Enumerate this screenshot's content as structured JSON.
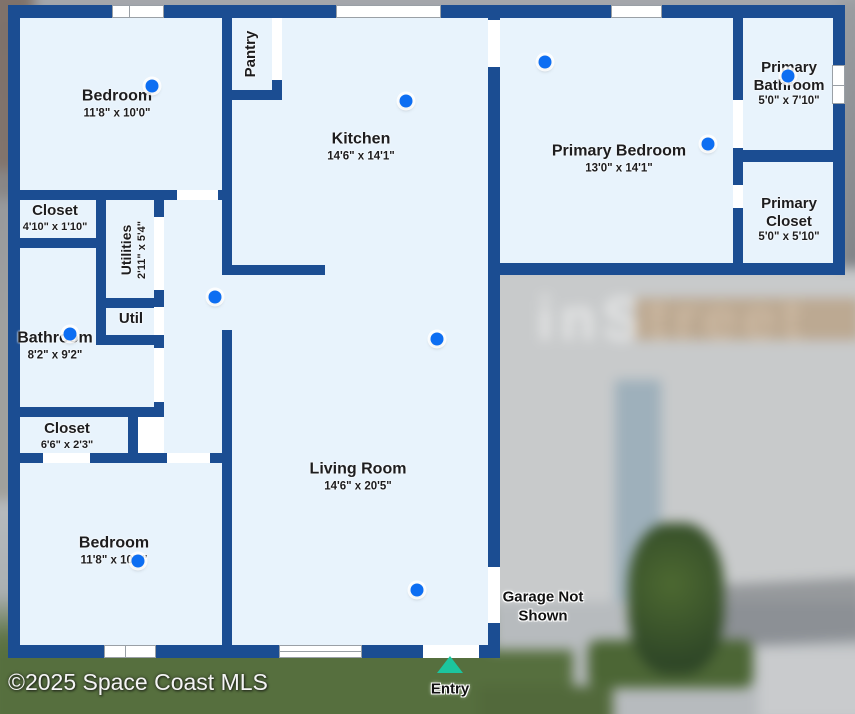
{
  "meta": {
    "copyright": "©2025 Space Coast MLS",
    "watermark": "inStreet"
  },
  "colors": {
    "wall": "#1b4d92",
    "room": "#e8f3fc",
    "dot": "#0d6ef2",
    "entry": "#1cc59e",
    "ink": "#1d1d1f"
  },
  "rooms": {
    "bedroom_top": {
      "name": "Bedroom",
      "dims": "11'8\" x 10'0\""
    },
    "pantry": {
      "name": "Pantry"
    },
    "kitchen": {
      "name": "Kitchen",
      "dims": "14'6\" x 14'1\""
    },
    "primary_bedroom": {
      "name": "Primary Bedroom",
      "dims": "13'0\" x 14'1\""
    },
    "primary_bathroom": {
      "name": "Primary Bathroom",
      "dims": "5'0\" x 7'10\""
    },
    "primary_closet": {
      "name": "Primary Closet",
      "dims": "5'0\" x 5'10\""
    },
    "closet_top": {
      "name": "Closet",
      "dims": "4'10\" x 1'10\""
    },
    "utilities": {
      "name": "Utilities",
      "dims": "2'11\" x 5'4\""
    },
    "util": {
      "name": "Util"
    },
    "bathroom": {
      "name": "Bathroom",
      "dims": "8'2\" x 9'2\""
    },
    "closet_bottom": {
      "name": "Closet",
      "dims": "6'6\" x 2'3\""
    },
    "bedroom_bottom": {
      "name": "Bedroom",
      "dims": "11'8\" x 10'0\""
    },
    "living_room": {
      "name": "Living Room",
      "dims": "14'6\" x 20'5\""
    }
  },
  "annotations": {
    "garage_note_line1": "Garage Not",
    "garage_note_line2": "Shown",
    "entry": "Entry"
  },
  "camera_dots": [
    {
      "x": 152,
      "y": 86
    },
    {
      "x": 406,
      "y": 101
    },
    {
      "x": 545,
      "y": 62
    },
    {
      "x": 708,
      "y": 144
    },
    {
      "x": 788,
      "y": 76
    },
    {
      "x": 215,
      "y": 297
    },
    {
      "x": 70,
      "y": 334
    },
    {
      "x": 437,
      "y": 339
    },
    {
      "x": 417,
      "y": 590
    },
    {
      "x": 138,
      "y": 561
    }
  ]
}
